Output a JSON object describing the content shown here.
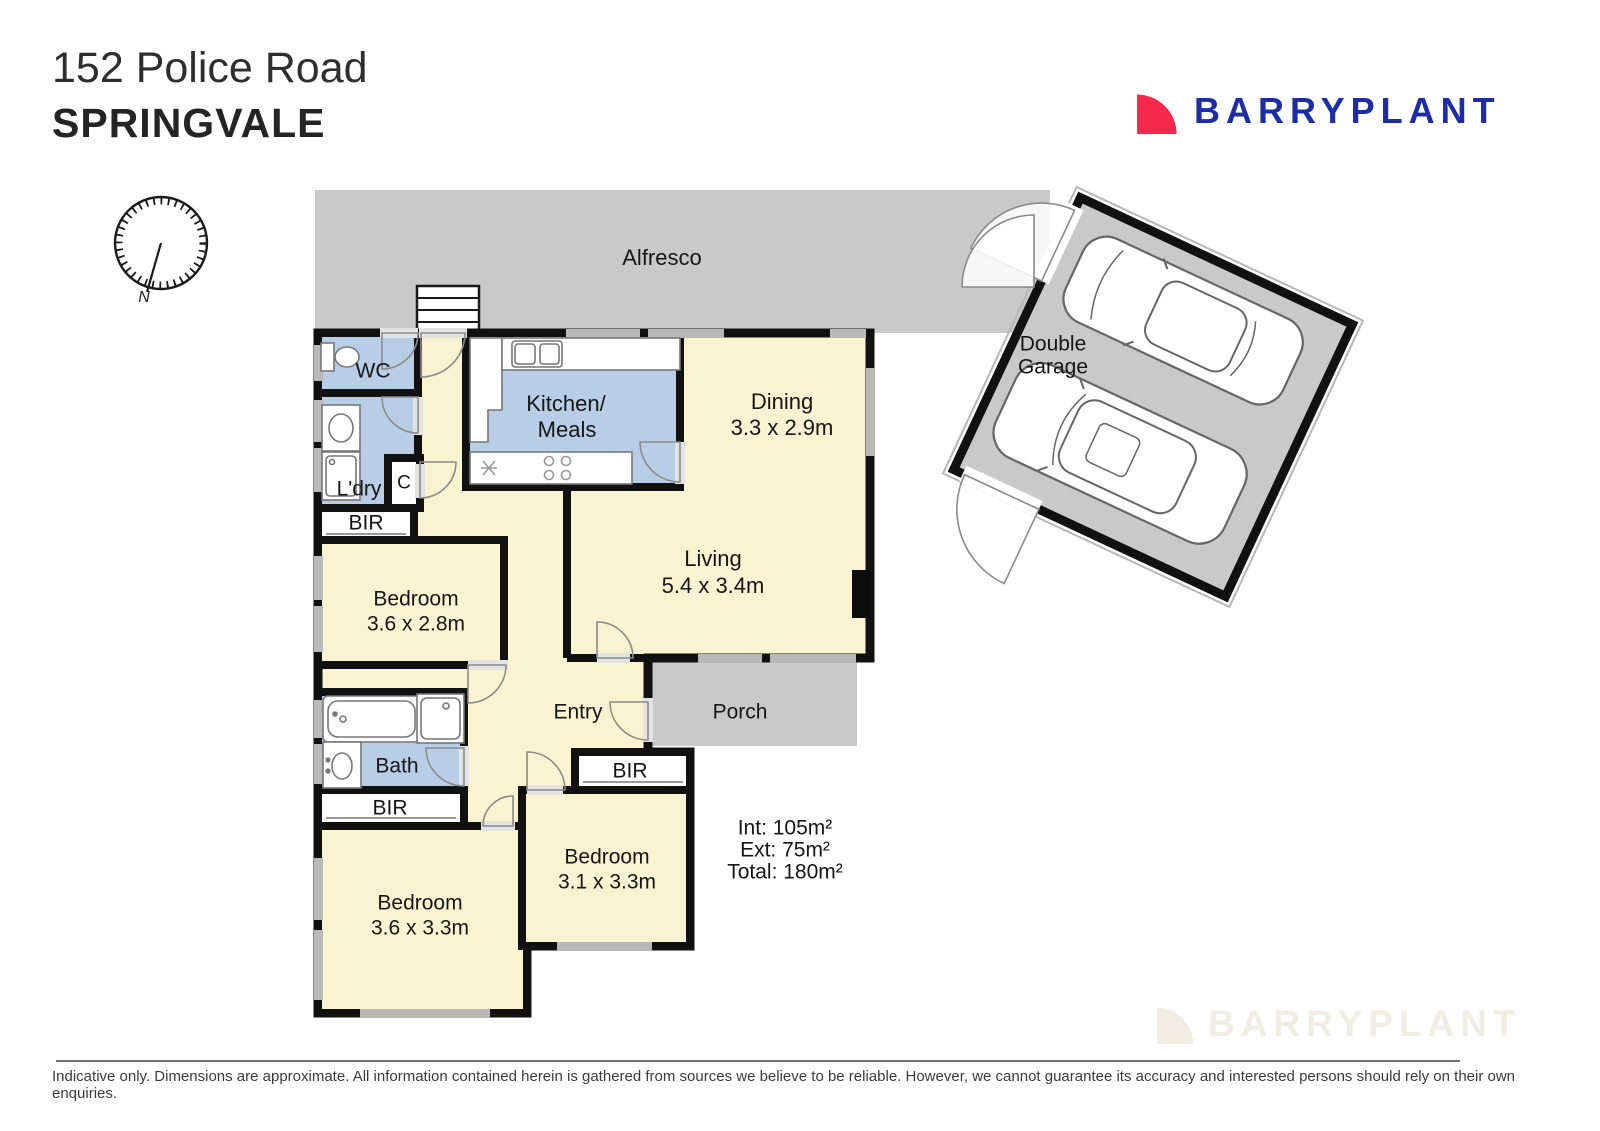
{
  "header": {
    "address_line1": "152 Police Road",
    "address_line2": "SPRINGVALE"
  },
  "brand": {
    "name": "BARRYPLANT",
    "red": "#f6294c",
    "blue": "#1c2da6"
  },
  "compass": {
    "north_label": "N"
  },
  "plan": {
    "outdoor": {
      "alfresco": "Alfresco",
      "porch": "Porch",
      "garage_line1": "Double",
      "garage_line2": "Garage"
    },
    "rooms": {
      "wc": "WC",
      "laundry": "L'dry",
      "closet": "C",
      "robe": "BIR",
      "kitchen_line1": "Kitchen/",
      "kitchen_line2": "Meals",
      "dining_name": "Dining",
      "dining_dims": "3.3 x 2.9m",
      "living_name": "Living",
      "living_dims": "5.4 x 3.4m",
      "bedroom1_name": "Bedroom",
      "bedroom1_dims": "3.6 x 2.8m",
      "bedroom2_name": "Bedroom",
      "bedroom2_dims": "3.6 x 3.3m",
      "bedroom3_name": "Bedroom",
      "bedroom3_dims": "3.1 x 3.3m",
      "entry": "Entry",
      "bath": "Bath"
    },
    "areas": {
      "internal": "Int: 105m²",
      "external": "Ext: 75m²",
      "total": "Total: 180m²"
    }
  },
  "watermark": {
    "brand": "BARRYPLANT"
  },
  "footer": {
    "disclaimer": "Indicative only. Dimensions are approximate. All information contained herein is gathered from sources we believe to be reliable. However, we cannot guarantee its accuracy and interested persons should rely on their own enquiries."
  },
  "colors": {
    "floor": "#faf3d1",
    "wet": "#b8cde6",
    "outdoor": "#c9c9c9",
    "wall": "#111111"
  }
}
